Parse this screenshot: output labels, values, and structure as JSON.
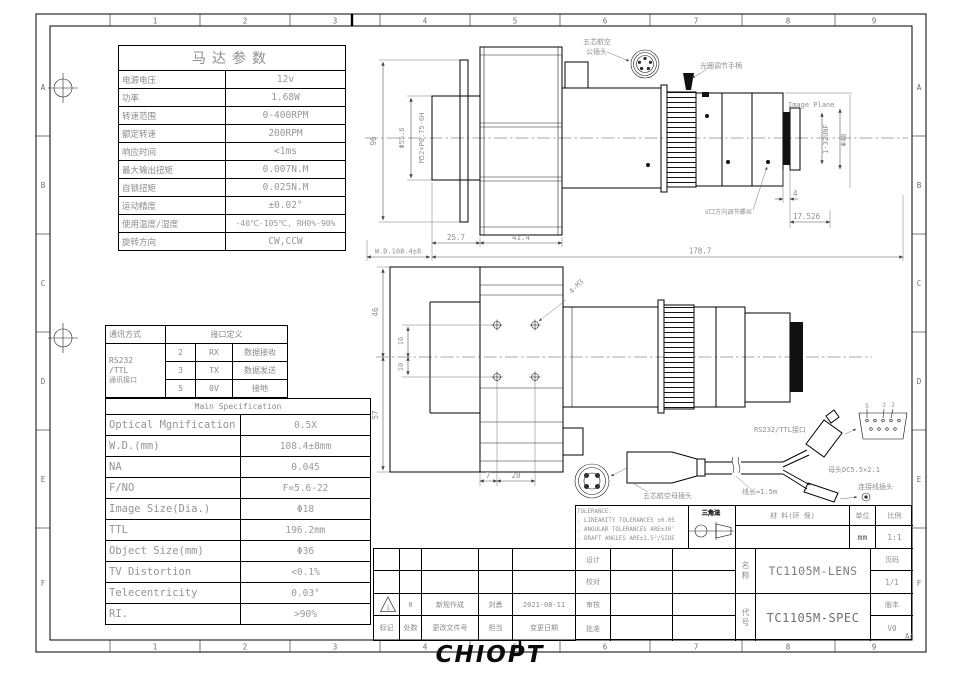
{
  "frame": {
    "cols": [
      "1",
      "2",
      "3",
      "4",
      "5",
      "6",
      "7",
      "8",
      "9"
    ],
    "rows": [
      "A",
      "B",
      "C",
      "D",
      "E",
      "F"
    ],
    "paper": "A4"
  },
  "logo": "CHIOPT",
  "motor_table": {
    "title": "马达参数",
    "rows": [
      {
        "label": "电源电压",
        "value": "12v"
      },
      {
        "label": "功率",
        "value": "1.68W"
      },
      {
        "label": "转速范围",
        "value": "0-400RPM"
      },
      {
        "label": "额定转速",
        "value": "200RPM"
      },
      {
        "label": "响应时间",
        "value": "<1ms"
      },
      {
        "label": "最大输出扭矩",
        "value": "0.007N.M"
      },
      {
        "label": "自锁扭矩",
        "value": "0.025N.M"
      },
      {
        "label": "运动精度",
        "value": "±0.02°"
      },
      {
        "label": "使用温度/湿度",
        "value": "-40℃-105℃, RH0%-90%"
      },
      {
        "label": "旋转方向",
        "value": "CW,CCW"
      }
    ]
  },
  "comm_table": {
    "method_header": "通讯方式",
    "def_header": "接口定义",
    "method_l1": "RS232",
    "method_l2": "/TTL",
    "method_l3": "通讯接口",
    "pins": [
      {
        "pin": "2",
        "signal": "RX",
        "desc": "数据接收"
      },
      {
        "pin": "3",
        "signal": "TX",
        "desc": "数据发送"
      },
      {
        "pin": "5",
        "signal": "0V",
        "desc": "接地"
      }
    ]
  },
  "spec_table": {
    "title": "Main Specification",
    "rows": [
      {
        "label": "Optical Mgnification",
        "value": "0.5X"
      },
      {
        "label": "W.D.(mm)",
        "value": "108.4±8mm"
      },
      {
        "label": "NA",
        "value": "0.045"
      },
      {
        "label": "F/NO",
        "value": "F=5.6-22"
      },
      {
        "label": "Image Size(Dia.)",
        "value": "Φ18"
      },
      {
        "label": "TTL",
        "value": "196.2mm"
      },
      {
        "label": "Object Size(mm)",
        "value": "Φ36"
      },
      {
        "label": "TV Distortion",
        "value": "<0.1%"
      },
      {
        "label": "Telecentricity",
        "value": "0.03°"
      },
      {
        "label": "RI.",
        "value": ">90%"
      }
    ]
  },
  "top_view": {
    "label_connector_l1": "五芯航空",
    "label_connector_l2": "公插头",
    "label_aperture": "光圈调节手柄",
    "label_image_plane": "Image Plane",
    "label_v_port": "V口方向调节螺丝",
    "dim_96": "96",
    "dim_phi556": "Φ55.6",
    "dim_thread": "M52×P0.75-6H",
    "dim_257": "25.7",
    "dim_414": "41.4",
    "dim_1787": "178.7",
    "dim_wd": "W.D.108.4±8",
    "dim_4": "4",
    "dim_17526": "17.526",
    "dim_unf": "1-32UNF",
    "dim_phi48": "Φ48"
  },
  "bottom_view": {
    "dim_46": "46",
    "dim_57": "57",
    "dim_16": "16",
    "dim_10": "10",
    "dim_7": "7",
    "dim_20": "20",
    "label_4m3": "4-M3"
  },
  "cable": {
    "label_rs232": "RS232/TTL接口",
    "label_dc": "母头DC5.5×2.1",
    "label_plug": "连接线插头",
    "label_female": "五芯航空母插头",
    "label_length": "线长≈1.5m",
    "pin5": "5",
    "pin3": "3",
    "pin2": "2"
  },
  "title_block": {
    "tolerance_line0": "TOLERANCE:",
    "tolerance_line1": ". LINEARITY TOLERANCES ±0.05",
    "tolerance_line2": ". ANGULAR TOLERANCES ARE±30'",
    "tolerance_line3": ". DRAFT ANGLES ARE±1.5°/SIDE",
    "projection_label": "三角法",
    "material_label": "材 料(环 保)",
    "unit_label": "单位",
    "unit_value": "mm",
    "scale_label": "比例",
    "scale_value": "1:1",
    "design": "设计",
    "proof": "校对",
    "review": "审核",
    "approve": "批准",
    "name_label": "名称",
    "name_value": "TC1105M-LENS",
    "code_label": "代号",
    "code_value": "TC1105M-SPEC",
    "page_label": "页码",
    "page_value": "1/1",
    "version_label": "版本",
    "version_value": "V0"
  },
  "revision": {
    "mark_no": "1",
    "r1_count": "0",
    "r1_desc": "新规作成",
    "r1_by": "刘勇",
    "r1_date": "2021-08-11",
    "h_mark": "标记",
    "h_count": "处数",
    "h_doc": "更改文件号",
    "h_resp": "担当",
    "h_date": "变更日期"
  }
}
